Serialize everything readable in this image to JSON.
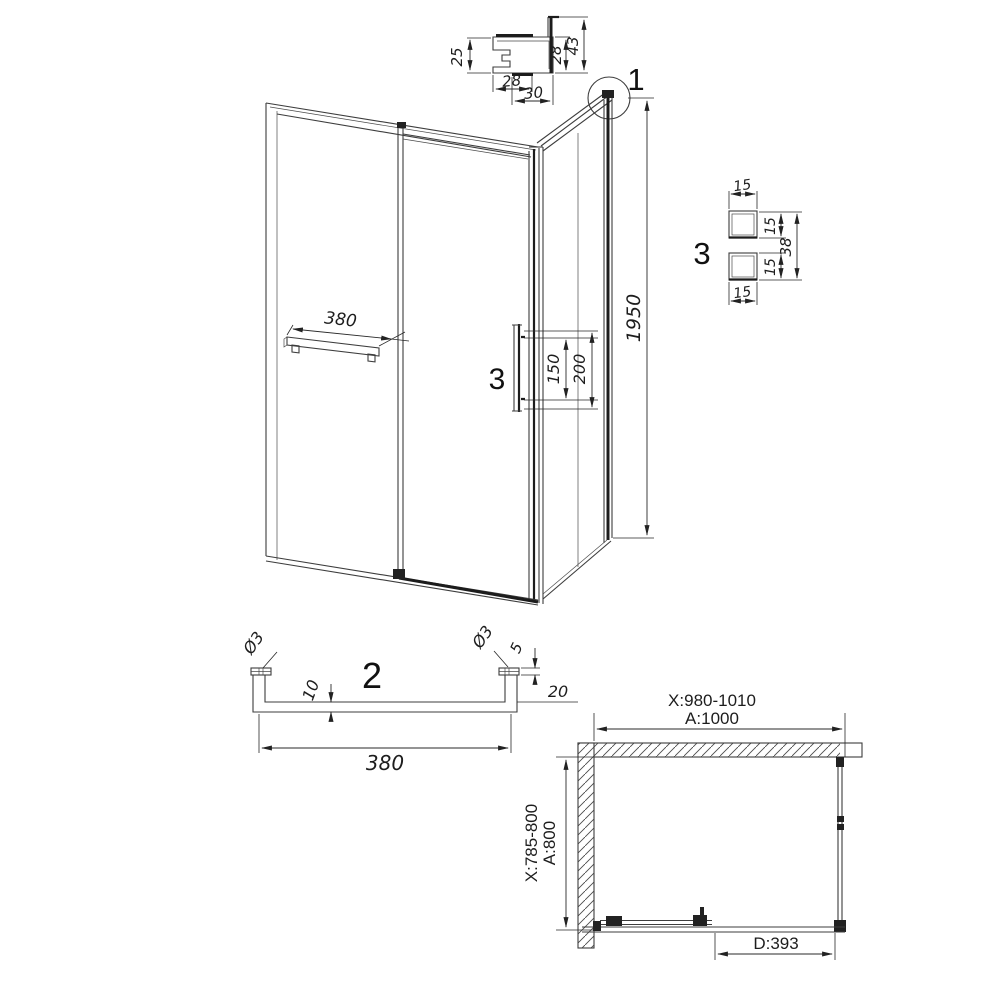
{
  "callout_labels": {
    "detail1": "1",
    "detail2": "2",
    "detail3_main": "3",
    "detail3": "3"
  },
  "profile_detail": {
    "height": "25",
    "inner_height": "28",
    "outer_height": "43",
    "bottom_width": "28",
    "bottom_outer_width": "30"
  },
  "front_view": {
    "towel_bar_length": "380",
    "handle_mount_spacing": "150",
    "handle_length": "200",
    "overall_height": "1950"
  },
  "handle_section_detail": {
    "top_width": "15",
    "top_depth": "15",
    "overall_depth": "38",
    "bottom_depth": "15",
    "bottom_width": "15"
  },
  "towel_bar_detail": {
    "screw_dia_left": "Ø3",
    "screw_dia_right": "Ø3",
    "cap_height": "5",
    "bar_thickness": "10",
    "bracket_depth": "20",
    "length": "380"
  },
  "plan_view": {
    "width_adjustment_range": "X:980-1010",
    "width_nominal": "A:1000",
    "depth_adjustment_range": "X:785-800",
    "depth_nominal": "A:800",
    "door_opening": "D:393"
  }
}
